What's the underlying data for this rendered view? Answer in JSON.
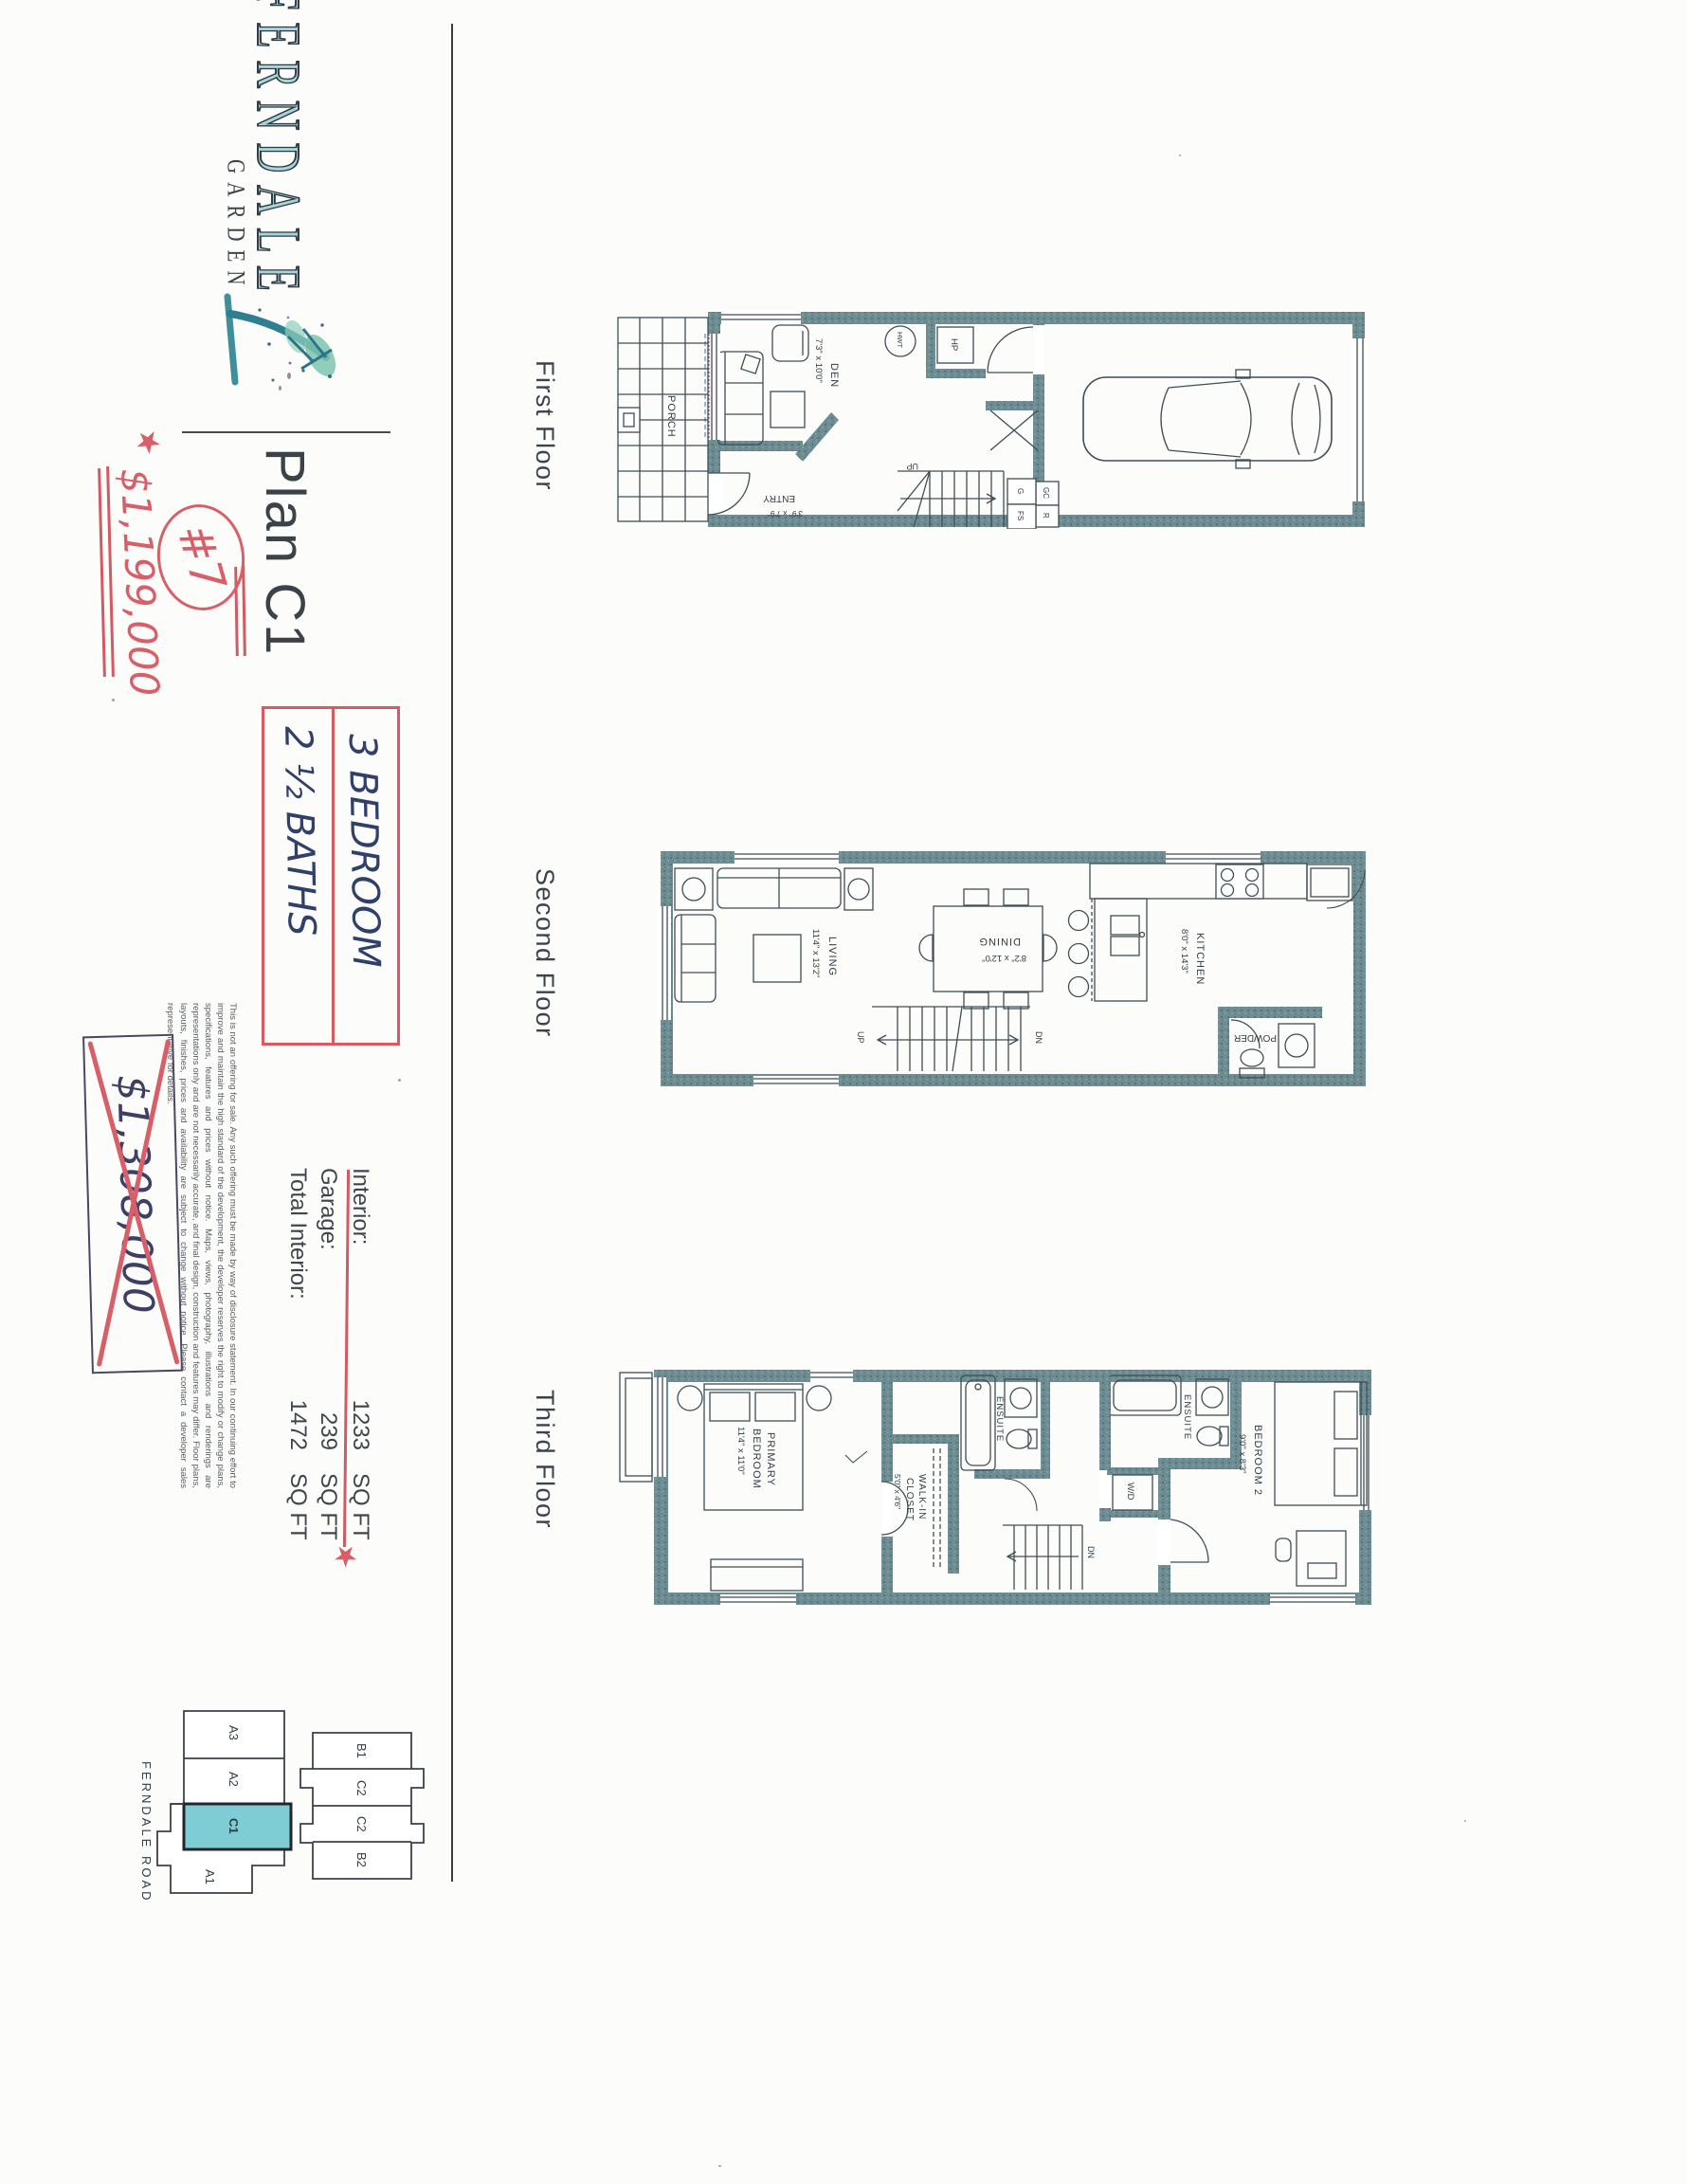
{
  "logo": {
    "line1": "FERNDALE",
    "line2": "GARDEN"
  },
  "plan": {
    "title": "Plan C1"
  },
  "annotations": {
    "unit_number": "#7",
    "price_new": "$1,199,000",
    "price_old": "$1,308,000",
    "bedrooms": "3 BEDROOM",
    "baths": "2 ½ BATHS",
    "star": "★"
  },
  "stats": {
    "rows": [
      {
        "label": "Interior:",
        "value": "1233",
        "unit": "SQ FT"
      },
      {
        "label": "Garage:",
        "value": "239",
        "unit": "SQ FT"
      },
      {
        "label": "Total Interior:",
        "value": "1472",
        "unit": "SQ FT"
      }
    ]
  },
  "floors": [
    {
      "label": "First Floor",
      "rooms": {
        "porch": "PORCH",
        "den": "DEN",
        "den_dim": "7'3\" x 10'0\"",
        "entry": "ENTRY",
        "entry_dim": "3'9\" x 7'9\"",
        "hwt": "HWT",
        "hp": "HP",
        "up": "UP",
        "g": "G",
        "fs": "FS",
        "gc": "GC",
        "r": "R"
      }
    },
    {
      "label": "Second Floor",
      "rooms": {
        "living": "LIVING",
        "living_dim": "11'4\" x 13'2\"",
        "dining": "DINING",
        "dining_dim": "8'2\" x 12'0\"",
        "kitchen": "KITCHEN",
        "kitchen_dim": "8'0\" x 14'3\"",
        "powder": "POWDER",
        "up": "UP",
        "dn": "DN"
      }
    },
    {
      "label": "Third Floor",
      "rooms": {
        "primary1": "PRIMARY",
        "primary2": "BEDROOM",
        "primary_dim": "11'4\" x 11'0\"",
        "walkin1": "WALK-IN",
        "walkin2": "CLOSET",
        "walkin_dim": "5'0\" x 4'6\"",
        "ensuite1": "ENSUITE",
        "ensuite2": "ENSUITE",
        "bedroom2": "BEDROOM 2",
        "bedroom2_dim": "9'0\" x 8'3\"",
        "wd": "W/D",
        "dn": "DN"
      }
    }
  ],
  "site_plan": {
    "road": "FERNDALE ROAD",
    "building_top": [
      "B1",
      "C2",
      "C2",
      "B2"
    ],
    "building_bottom": [
      "A3",
      "A2",
      "C1",
      "A1"
    ],
    "highlighted_unit": "C1"
  },
  "disclaimer": "This is not an offering for sale. Any such offering must be made by way of disclosure statement. In our continuing effort to improve and maintain the high standard of the development, the developer reserves the right to modify or change plans, specifications, features and prices without notice. Maps, views, photography, illustrations and renderings are representations only and are not necessarily accurate, and final design, construction and features may differ. Floor plans, layouts, finishes, prices and availability are subject to change without notice. Please contact a developer sales representative for details.",
  "colors": {
    "accent_red": "#d85f68",
    "ink_navy": "#31406b",
    "wall_teal": "#6d8d93",
    "unit_highlight": "#7ecdd4"
  }
}
